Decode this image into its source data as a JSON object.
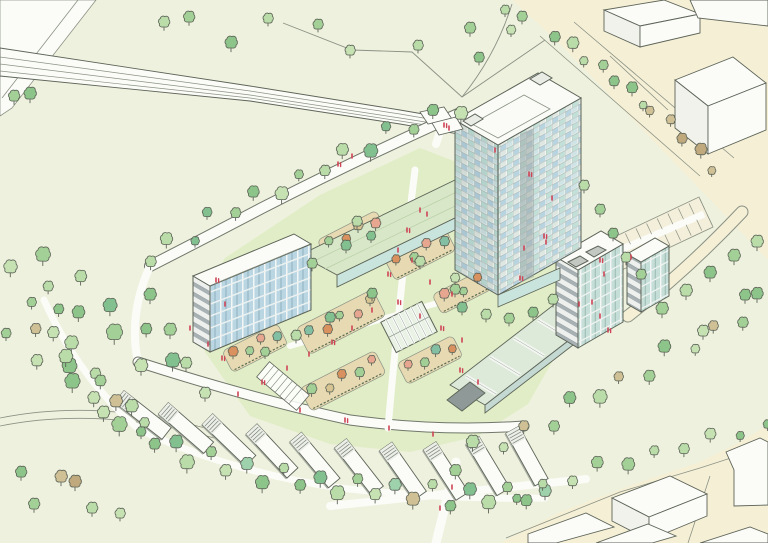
{
  "scene": {
    "type": "architectural aerial perspective sketch",
    "description": "Hand-drawn masterplan illustration: a crescent-shaped landscaped development with a high-rise checkered tower, two mid-rise apartment blocks with green-roof wings, radial rows of white terraced houses, orchard garden beds with a greenhouse, a parking court, tree-lined roads, a railway line and white context buildings.",
    "width": 768,
    "height": 543
  },
  "palette": {
    "bg": "#eef1dd",
    "lawn": "#e0edc6",
    "cream": "#f5efd6",
    "paper": "#fbfcf8",
    "outline": "#5d6458",
    "lineLight": "#8b9284",
    "casing": "#70776a",
    "glassBlue": "#b9d6e2",
    "glassTeal": "#c9e4dc",
    "facadeGray": "#a7b1b3",
    "facadeDark": "#8f9a98",
    "greenRoof": "#d8e7c8",
    "skylight": "#dde9d9",
    "bedTan": "#e7dab3",
    "hedge": "#5a6b50",
    "red": "#cf4456",
    "tree": {
      "g0": "#a3d096",
      "g1": "#b9dca8",
      "g2": "#8cc489",
      "g3": "#c6e2b3",
      "g4": "#82c090",
      "g5": "#9ed2ac",
      "t0": "#cfc095",
      "t1": "#bfa97d"
    },
    "orchard": {
      "orange": "#d9925f",
      "salmon": "#e6a68f",
      "green": "#a2cf95",
      "teal": "#83bfa3",
      "tan": "#d6c493"
    }
  },
  "elements": {
    "tower": {
      "label": "high-rise tower with checkered blue-green glazed facade",
      "floors_visible": 13
    },
    "west_block": {
      "label": "mid-rise apartment block with blue glazed facade",
      "floors_visible": 5
    },
    "west_wing": {
      "label": "low green-roof wing linking west block to tower"
    },
    "east_block": {
      "label": "mid-rise apartment block with banded facade",
      "floors_visible": 7
    },
    "east_wing": {
      "label": "low terrace wing with pale-green skylight roofs"
    },
    "terrace_houses": {
      "label": "white terraced house rows arranged radially along the crescent",
      "count": 10
    },
    "greenhouse": {
      "label": "glass greenhouse in orchard garden"
    },
    "pergola": {
      "label": "timber pergola canopy"
    },
    "orchard_beds": {
      "label": "planted orchard beds with fruit trees and hedges",
      "count": 7
    },
    "parking_court": {
      "label": "surface parking court with marked bays"
    },
    "railway": {
      "label": "railway line crossing the top of the site"
    },
    "railway_crossing": {
      "label": "level crossing onto the site access road"
    },
    "context_buildings": {
      "label": "white existing context buildings",
      "count": 9
    },
    "trees": {
      "label": "sketch trees in greens and tans",
      "count_approx": 154
    },
    "people": {
      "label": "small red figure marks",
      "count": 50
    }
  },
  "singles": [
    [
      14,
      101,
      11,
      "g0"
    ],
    [
      30,
      99,
      12,
      "g2"
    ],
    [
      164,
      27,
      11,
      "g1"
    ],
    [
      189,
      22,
      11,
      "g0"
    ],
    [
      231,
      48,
      12,
      "g2"
    ],
    [
      268,
      23,
      10,
      "g1"
    ],
    [
      318,
      29,
      10,
      "g0"
    ],
    [
      350,
      55,
      10,
      "g3"
    ],
    [
      418,
      50,
      10,
      "g1"
    ],
    [
      470,
      33,
      11,
      "g0"
    ],
    [
      479,
      62,
      10,
      "g2"
    ],
    [
      505,
      14,
      9,
      "g1"
    ],
    [
      522,
      21,
      10,
      "g0"
    ],
    [
      511,
      34,
      9,
      "g3"
    ],
    [
      21,
      477,
      11,
      "g2"
    ],
    [
      34,
      509,
      11,
      "g0"
    ],
    [
      61,
      482,
      12,
      "t0"
    ],
    [
      75,
      487,
      12,
      "t1"
    ],
    [
      92,
      513,
      11,
      "g1"
    ],
    [
      120,
      518,
      10,
      "g3"
    ],
    [
      757,
      247,
      12,
      "g1"
    ],
    [
      734,
      261,
      12,
      "g0"
    ],
    [
      710,
      278,
      12,
      "g2"
    ],
    [
      686,
      296,
      12,
      "g1"
    ],
    [
      662,
      314,
      12,
      "g0"
    ],
    [
      703,
      336,
      11,
      "g3"
    ],
    [
      745,
      300,
      11,
      "g2"
    ],
    [
      584,
      190,
      10,
      "g1"
    ],
    [
      600,
      214,
      10,
      "g0"
    ],
    [
      613,
      238,
      10,
      "g2"
    ],
    [
      626,
      262,
      10,
      "g1"
    ],
    [
      641,
      279,
      10,
      "g0"
    ],
    [
      462,
      312,
      10,
      "g4"
    ],
    [
      486,
      319,
      10,
      "g1"
    ],
    [
      509,
      323,
      10,
      "g0"
    ],
    [
      533,
      317,
      10,
      "g2"
    ],
    [
      553,
      304,
      10,
      "g1"
    ],
    [
      455,
      282,
      9,
      "g3"
    ],
    [
      357,
      226,
      10,
      "g1"
    ],
    [
      371,
      240,
      9,
      "g4"
    ],
    [
      312,
      268,
      10,
      "g0"
    ],
    [
      346,
      250,
      10,
      "g4"
    ],
    [
      420,
      266,
      10,
      "g1"
    ],
    [
      455,
      294,
      10,
      "g0"
    ],
    [
      372,
      298,
      10,
      "g2"
    ],
    [
      330,
      322,
      10,
      "g4"
    ],
    [
      296,
      340,
      10,
      "g1"
    ],
    [
      265,
      356,
      9,
      "g0"
    ],
    [
      150,
      300,
      12,
      "g2"
    ],
    [
      170,
      335,
      12,
      "g0"
    ],
    [
      186,
      368,
      11,
      "g1"
    ],
    [
      205,
      398,
      11,
      "g3"
    ]
  ],
  "belts": [
    {
      "name": "nw-boundary-trees",
      "pts": [
        [
          148,
          262
        ],
        [
          220,
          220
        ],
        [
          300,
          182
        ],
        [
          380,
          143
        ],
        [
          458,
          112
        ]
      ],
      "n": 15,
      "s": 11,
      "alt": 7,
      "colors": [
        "g0",
        "g1",
        "g2",
        "g3",
        "g4"
      ]
    },
    {
      "name": "outer-crescent-trees",
      "pts": [
        [
          40,
          302
        ],
        [
          66,
          352
        ],
        [
          96,
          398
        ],
        [
          138,
          436
        ],
        [
          192,
          462
        ],
        [
          258,
          479
        ],
        [
          332,
          491
        ],
        [
          412,
          498
        ],
        [
          482,
          501
        ],
        [
          545,
          501
        ]
      ],
      "n": 32,
      "s": 12,
      "alt": 8,
      "colors": [
        "g0",
        "g1",
        "g2",
        "g3",
        "g4",
        "g5",
        "t0",
        "g1",
        "g2"
      ]
    },
    {
      "name": "woodland-a",
      "pts": [
        [
          20,
          258
        ],
        [
          72,
          292
        ],
        [
          122,
          332
        ],
        [
          168,
          372
        ]
      ],
      "n": 10,
      "s": 13,
      "alt": 13,
      "colors": [
        "g0",
        "g1",
        "g2",
        "g3",
        "g4"
      ]
    },
    {
      "name": "woodland-b",
      "pts": [
        [
          12,
          330
        ],
        [
          58,
          366
        ],
        [
          104,
          402
        ],
        [
          146,
          428
        ]
      ],
      "n": 9,
      "s": 12,
      "alt": 11,
      "colors": [
        "g1",
        "g2",
        "g0",
        "t0",
        "g3"
      ]
    },
    {
      "name": "se-edge-trees",
      "pts": [
        [
          452,
          468
        ],
        [
          540,
          430
        ],
        [
          625,
          385
        ],
        [
          705,
          342
        ],
        [
          762,
          307
        ]
      ],
      "n": 14,
      "s": 11,
      "alt": 8,
      "colors": [
        "g0",
        "g2",
        "g1",
        "g3",
        "t0",
        "g4"
      ]
    },
    {
      "name": "se-street-trees",
      "pts": [
        [
          516,
          500
        ],
        [
          600,
          472
        ],
        [
          690,
          448
        ],
        [
          768,
          431
        ]
      ],
      "n": 10,
      "s": 10,
      "alt": 4,
      "colors": [
        "g1",
        "g3",
        "g0",
        "g2"
      ]
    },
    {
      "name": "ne-green-row",
      "pts": [
        [
          556,
          40
        ],
        [
          600,
          72
        ],
        [
          645,
          106
        ]
      ],
      "n": 7,
      "s": 10,
      "alt": 3,
      "colors": [
        "g0",
        "g2",
        "g1"
      ]
    },
    {
      "name": "ne-tan-row",
      "pts": [
        [
          652,
          112
        ],
        [
          682,
          140
        ],
        [
          714,
          172
        ]
      ],
      "n": 5,
      "s": 10,
      "alt": 3,
      "colors": [
        "t0",
        "t1"
      ]
    }
  ],
  "beds": [
    {
      "c": [
        352,
        236
      ],
      "w": 66,
      "h": 24,
      "rot": -27,
      "trees": [
        "green",
        "orange",
        "tan",
        "salmon"
      ]
    },
    {
      "c": [
        420,
        254
      ],
      "w": 68,
      "h": 26,
      "rot": -27,
      "trees": [
        "orange",
        "green",
        "salmon",
        "teal"
      ]
    },
    {
      "c": [
        462,
        292
      ],
      "w": 56,
      "h": 22,
      "rot": -27,
      "trees": [
        "salmon",
        "green",
        "orange"
      ]
    },
    {
      "c": [
        341,
        322
      ],
      "w": 86,
      "h": 30,
      "rot": -27,
      "trees": [
        "teal",
        "orange",
        "green",
        "salmon",
        "tan"
      ]
    },
    {
      "c": [
        430,
        360
      ],
      "w": 62,
      "h": 24,
      "rot": -27,
      "trees": [
        "salmon",
        "green",
        "teal",
        "orange"
      ]
    },
    {
      "c": [
        343,
        381
      ],
      "w": 84,
      "h": 26,
      "rot": -27,
      "trees": [
        "green",
        "tan",
        "orange",
        "green",
        "salmon"
      ]
    },
    {
      "c": [
        255,
        348
      ],
      "w": 62,
      "h": 24,
      "rot": -27,
      "trees": [
        "orange",
        "green",
        "salmon",
        "teal"
      ]
    }
  ],
  "houses": {
    "len": 60,
    "w": 15,
    "bars": [
      [
        143,
        415,
        38
      ],
      [
        186,
        428,
        41
      ],
      [
        229,
        440,
        44
      ],
      [
        272,
        451,
        47
      ],
      [
        315,
        460,
        50
      ],
      [
        359,
        467,
        52
      ],
      [
        403,
        471,
        55
      ],
      [
        446,
        471,
        57
      ],
      [
        488,
        466,
        59
      ],
      [
        527,
        456,
        61
      ]
    ]
  },
  "parking": {
    "a": [
      600,
      262
    ],
    "b": [
      706,
      212
    ],
    "n": 11,
    "half": 15
  },
  "people": [
    [
      444,
      127
    ],
    [
      449,
      130
    ],
    [
      352,
      158
    ],
    [
      338,
      166
    ],
    [
      420,
      212
    ],
    [
      427,
      216
    ],
    [
      407,
      232
    ],
    [
      398,
      252
    ],
    [
      412,
      262
    ],
    [
      388,
      276
    ],
    [
      430,
      284
    ],
    [
      452,
      296
    ],
    [
      398,
      304
    ],
    [
      372,
      312
    ],
    [
      420,
      318
    ],
    [
      441,
      330
    ],
    [
      462,
      342
    ],
    [
      352,
      330
    ],
    [
      332,
      344
    ],
    [
      309,
      356
    ],
    [
      287,
      370
    ],
    [
      262,
      384
    ],
    [
      238,
      396
    ],
    [
      300,
      412
    ],
    [
      345,
      422
    ],
    [
      389,
      430
    ],
    [
      433,
      436
    ],
    [
      460,
      372
    ],
    [
      478,
      384
    ],
    [
      208,
      346
    ],
    [
      222,
      360
    ],
    [
      190,
      330
    ],
    [
      579,
      306
    ],
    [
      600,
      262
    ],
    [
      631,
      259
    ],
    [
      604,
      276
    ],
    [
      544,
      238
    ],
    [
      524,
      250
    ],
    [
      495,
      152
    ],
    [
      529,
      176
    ],
    [
      552,
      200
    ],
    [
      546,
      244
    ],
    [
      520,
      280
    ],
    [
      592,
      304
    ],
    [
      600,
      318
    ],
    [
      608,
      332
    ],
    [
      452,
      489
    ],
    [
      440,
      510
    ],
    [
      216,
      282
    ],
    [
      225,
      306
    ]
  ]
}
